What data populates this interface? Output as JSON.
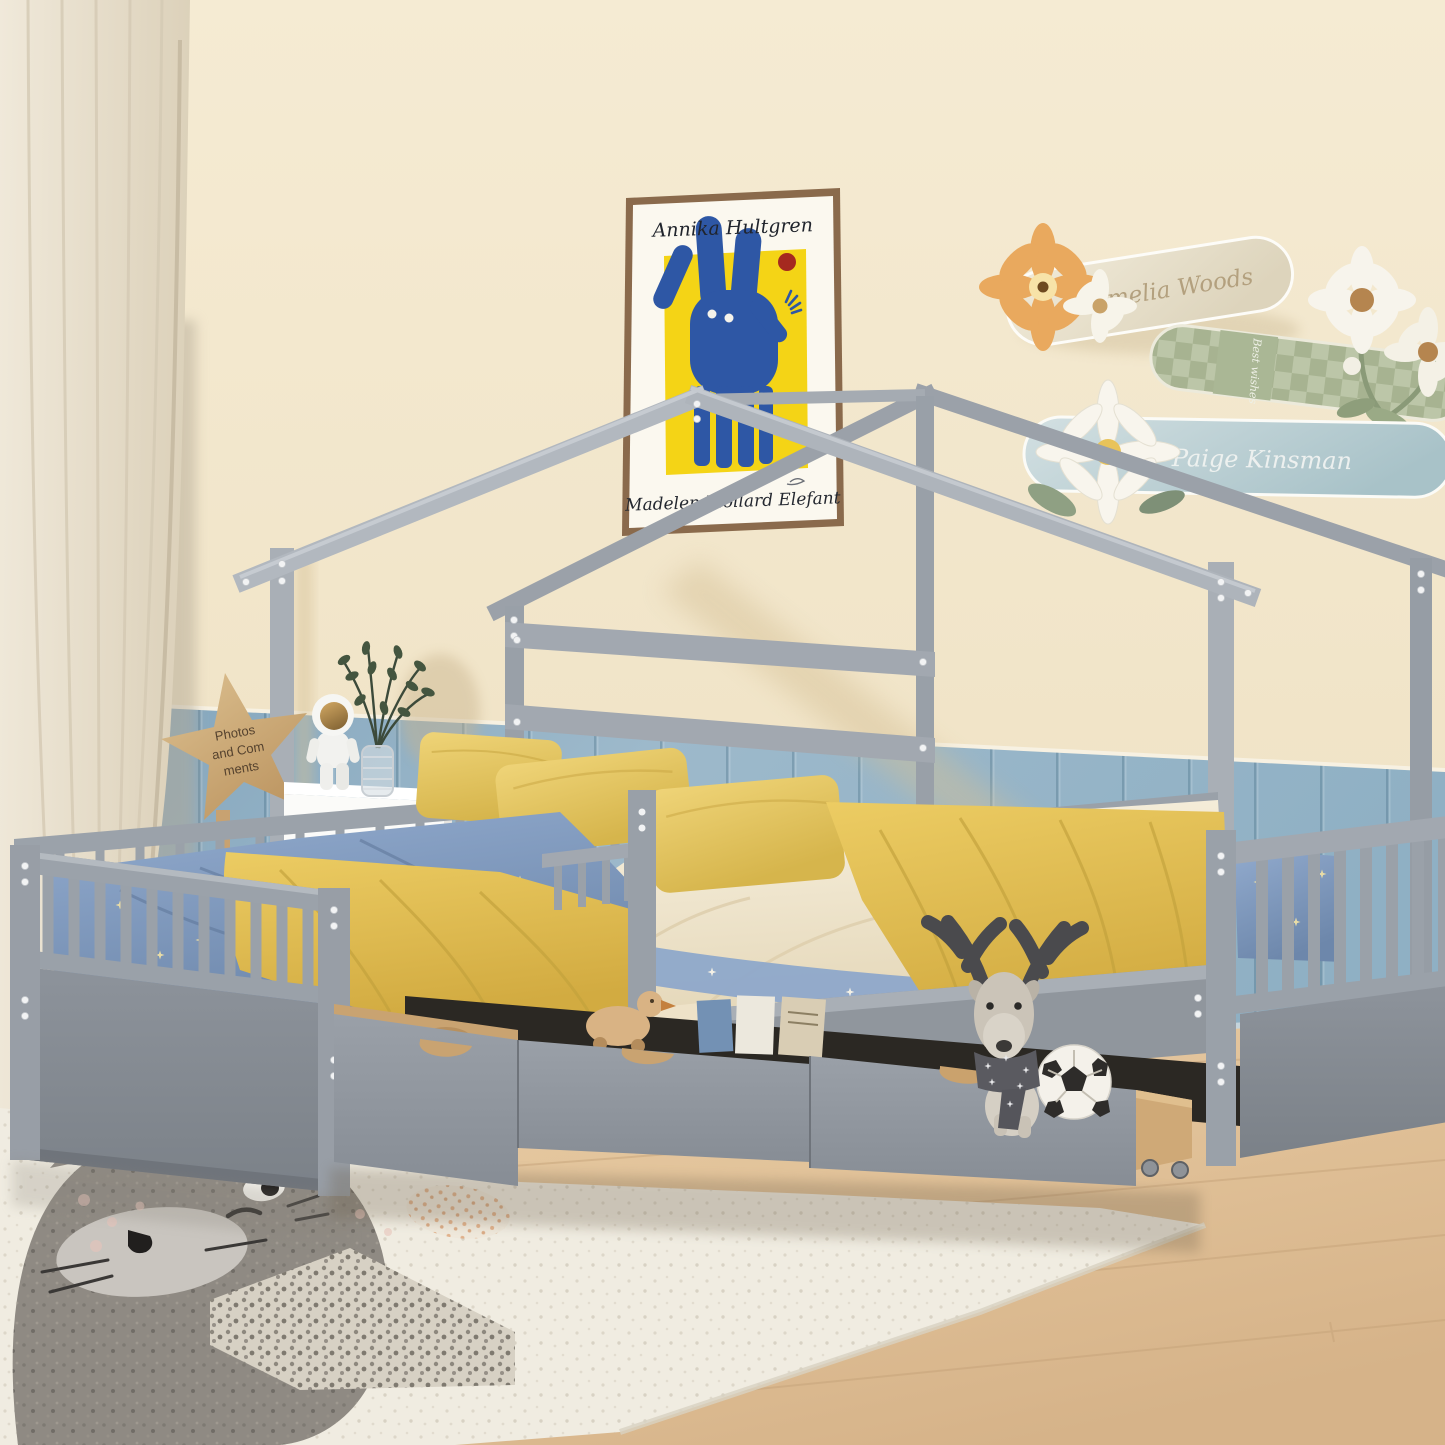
{
  "subject": "kids bedroom with gray L-shaped double house bed with storage drawers",
  "poster": {
    "artist": "Annika Hultgren",
    "title": "Madelen Mollard Elefant"
  },
  "star_sign": {
    "full_text": "Photos and Comments",
    "line1": "Photos",
    "line2": "and Com",
    "line3": "ments"
  },
  "plaques": {
    "first": {
      "text": "Amelia Woods"
    },
    "second": {
      "text": "Best wishes"
    },
    "third": {
      "text": "Paige Kinsman"
    }
  },
  "palette": {
    "wall": "#f1e4c9",
    "wainscot_blue": "#8fafc4",
    "floor_wood": "#e2c49e",
    "bed_frame_gray": "#9aa1a9",
    "bed_panel_gray": "#83888f",
    "blanket_yellow": "#e4c35e",
    "pillow_yellow": "#e7c964",
    "duvet_blue": "#7e9cc2",
    "sheet_cream": "#f2ead8",
    "rug_cream": "#f0ece1",
    "cat_gray": "#8f8a83",
    "poster_yellow": "#f4d416",
    "poster_blue": "#2e57a5",
    "poster_red_dot": "#a5291f",
    "drawer_wood": "#c9a371"
  }
}
